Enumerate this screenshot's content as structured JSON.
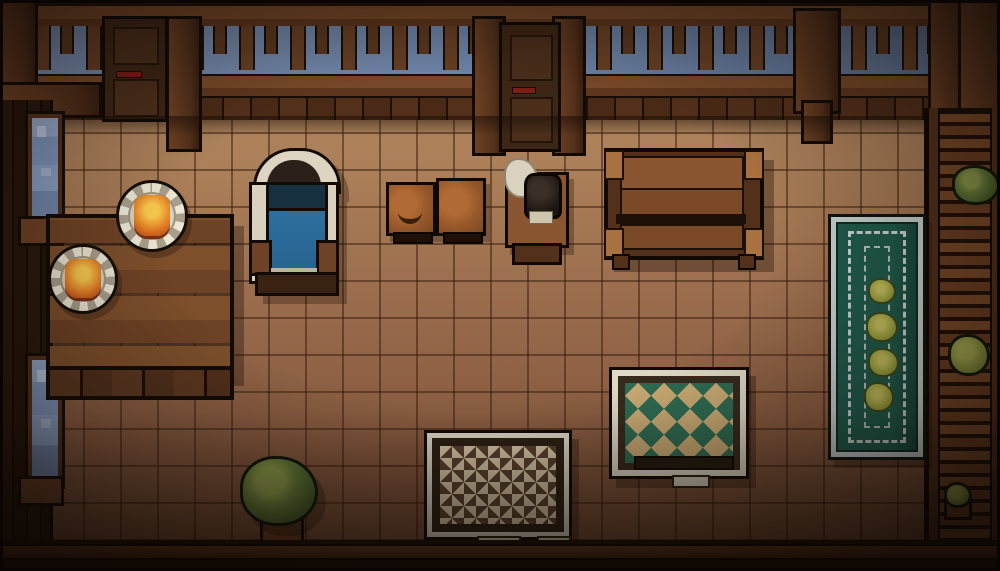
{
  "scene": {
    "title": "Pixel-art inn room — top-down interior",
    "style": "16-bit pixel art, dim warm lighting",
    "floor": "square brown tiles",
    "sky_visible_through_balustrade": true
  },
  "palette": {
    "floor_tile_light": "#b68e69",
    "floor_tile_dark": "#714a33",
    "grout": "#341a0c",
    "wall_wood": "#241509",
    "beam_wood": "#7b4b29",
    "sky_blue": "#7e93b8",
    "door_wood": "#3d2615",
    "door_latch_red": "#7e1e14",
    "bed_blue": "#2d6f9f",
    "linen_cream": "#ddd5c2",
    "fire_orange": "#ef9c33",
    "fire_yellow": "#f8c84e",
    "rug_teal": "#1e5c4c",
    "rug_border_white": "#cdd6d3",
    "rug_diamond_green": "#2e6b52",
    "rug_field_tan": "#c9ab74",
    "rug_checker_cream": "#d9caa6",
    "rug_checker_brown": "#5a4030",
    "plant_green": "#69803a",
    "flower_olive": "#a2a844"
  },
  "objects": [
    {
      "id": "door-left",
      "label": "Wooden door (top left)"
    },
    {
      "id": "door-center",
      "label": "Wooden door (top center)"
    },
    {
      "id": "window-upper",
      "label": "Tall window, left wall (upper)"
    },
    {
      "id": "window-lower",
      "label": "Tall window, left wall (lower)"
    },
    {
      "id": "dining-table",
      "label": "Plank dining table"
    },
    {
      "id": "fire-plate-1",
      "label": "Plate with lit flame (upper)"
    },
    {
      "id": "fire-plate-2",
      "label": "Plate with lit flame (lower)"
    },
    {
      "id": "bed",
      "label": "Blue bed with arched linen headboard"
    },
    {
      "id": "crate-stool-1",
      "label": "Small crate stool with bowl mark"
    },
    {
      "id": "crate-stool-2",
      "label": "Small crate stool"
    },
    {
      "id": "nightstand",
      "label": "Nightstand with dark jug and cloth"
    },
    {
      "id": "bench",
      "label": "Wooden bench"
    },
    {
      "id": "teal-runner-rug",
      "label": "Teal runner rug with four flowers"
    },
    {
      "id": "diamond-rug",
      "label": "Green diamond-pattern rug"
    },
    {
      "id": "checker-rug",
      "label": "Cream checkered rug"
    },
    {
      "id": "potted-plant",
      "label": "Potted bush plant"
    },
    {
      "id": "shelf-unit",
      "label": "Right wall plank shelves"
    },
    {
      "id": "shelf-bush-top",
      "label": "Bush on top shelf"
    },
    {
      "id": "shelf-bush-mid",
      "label": "Bush on middle shelf"
    },
    {
      "id": "small-plant",
      "label": "Small potted sprout (bottom right)"
    }
  ]
}
